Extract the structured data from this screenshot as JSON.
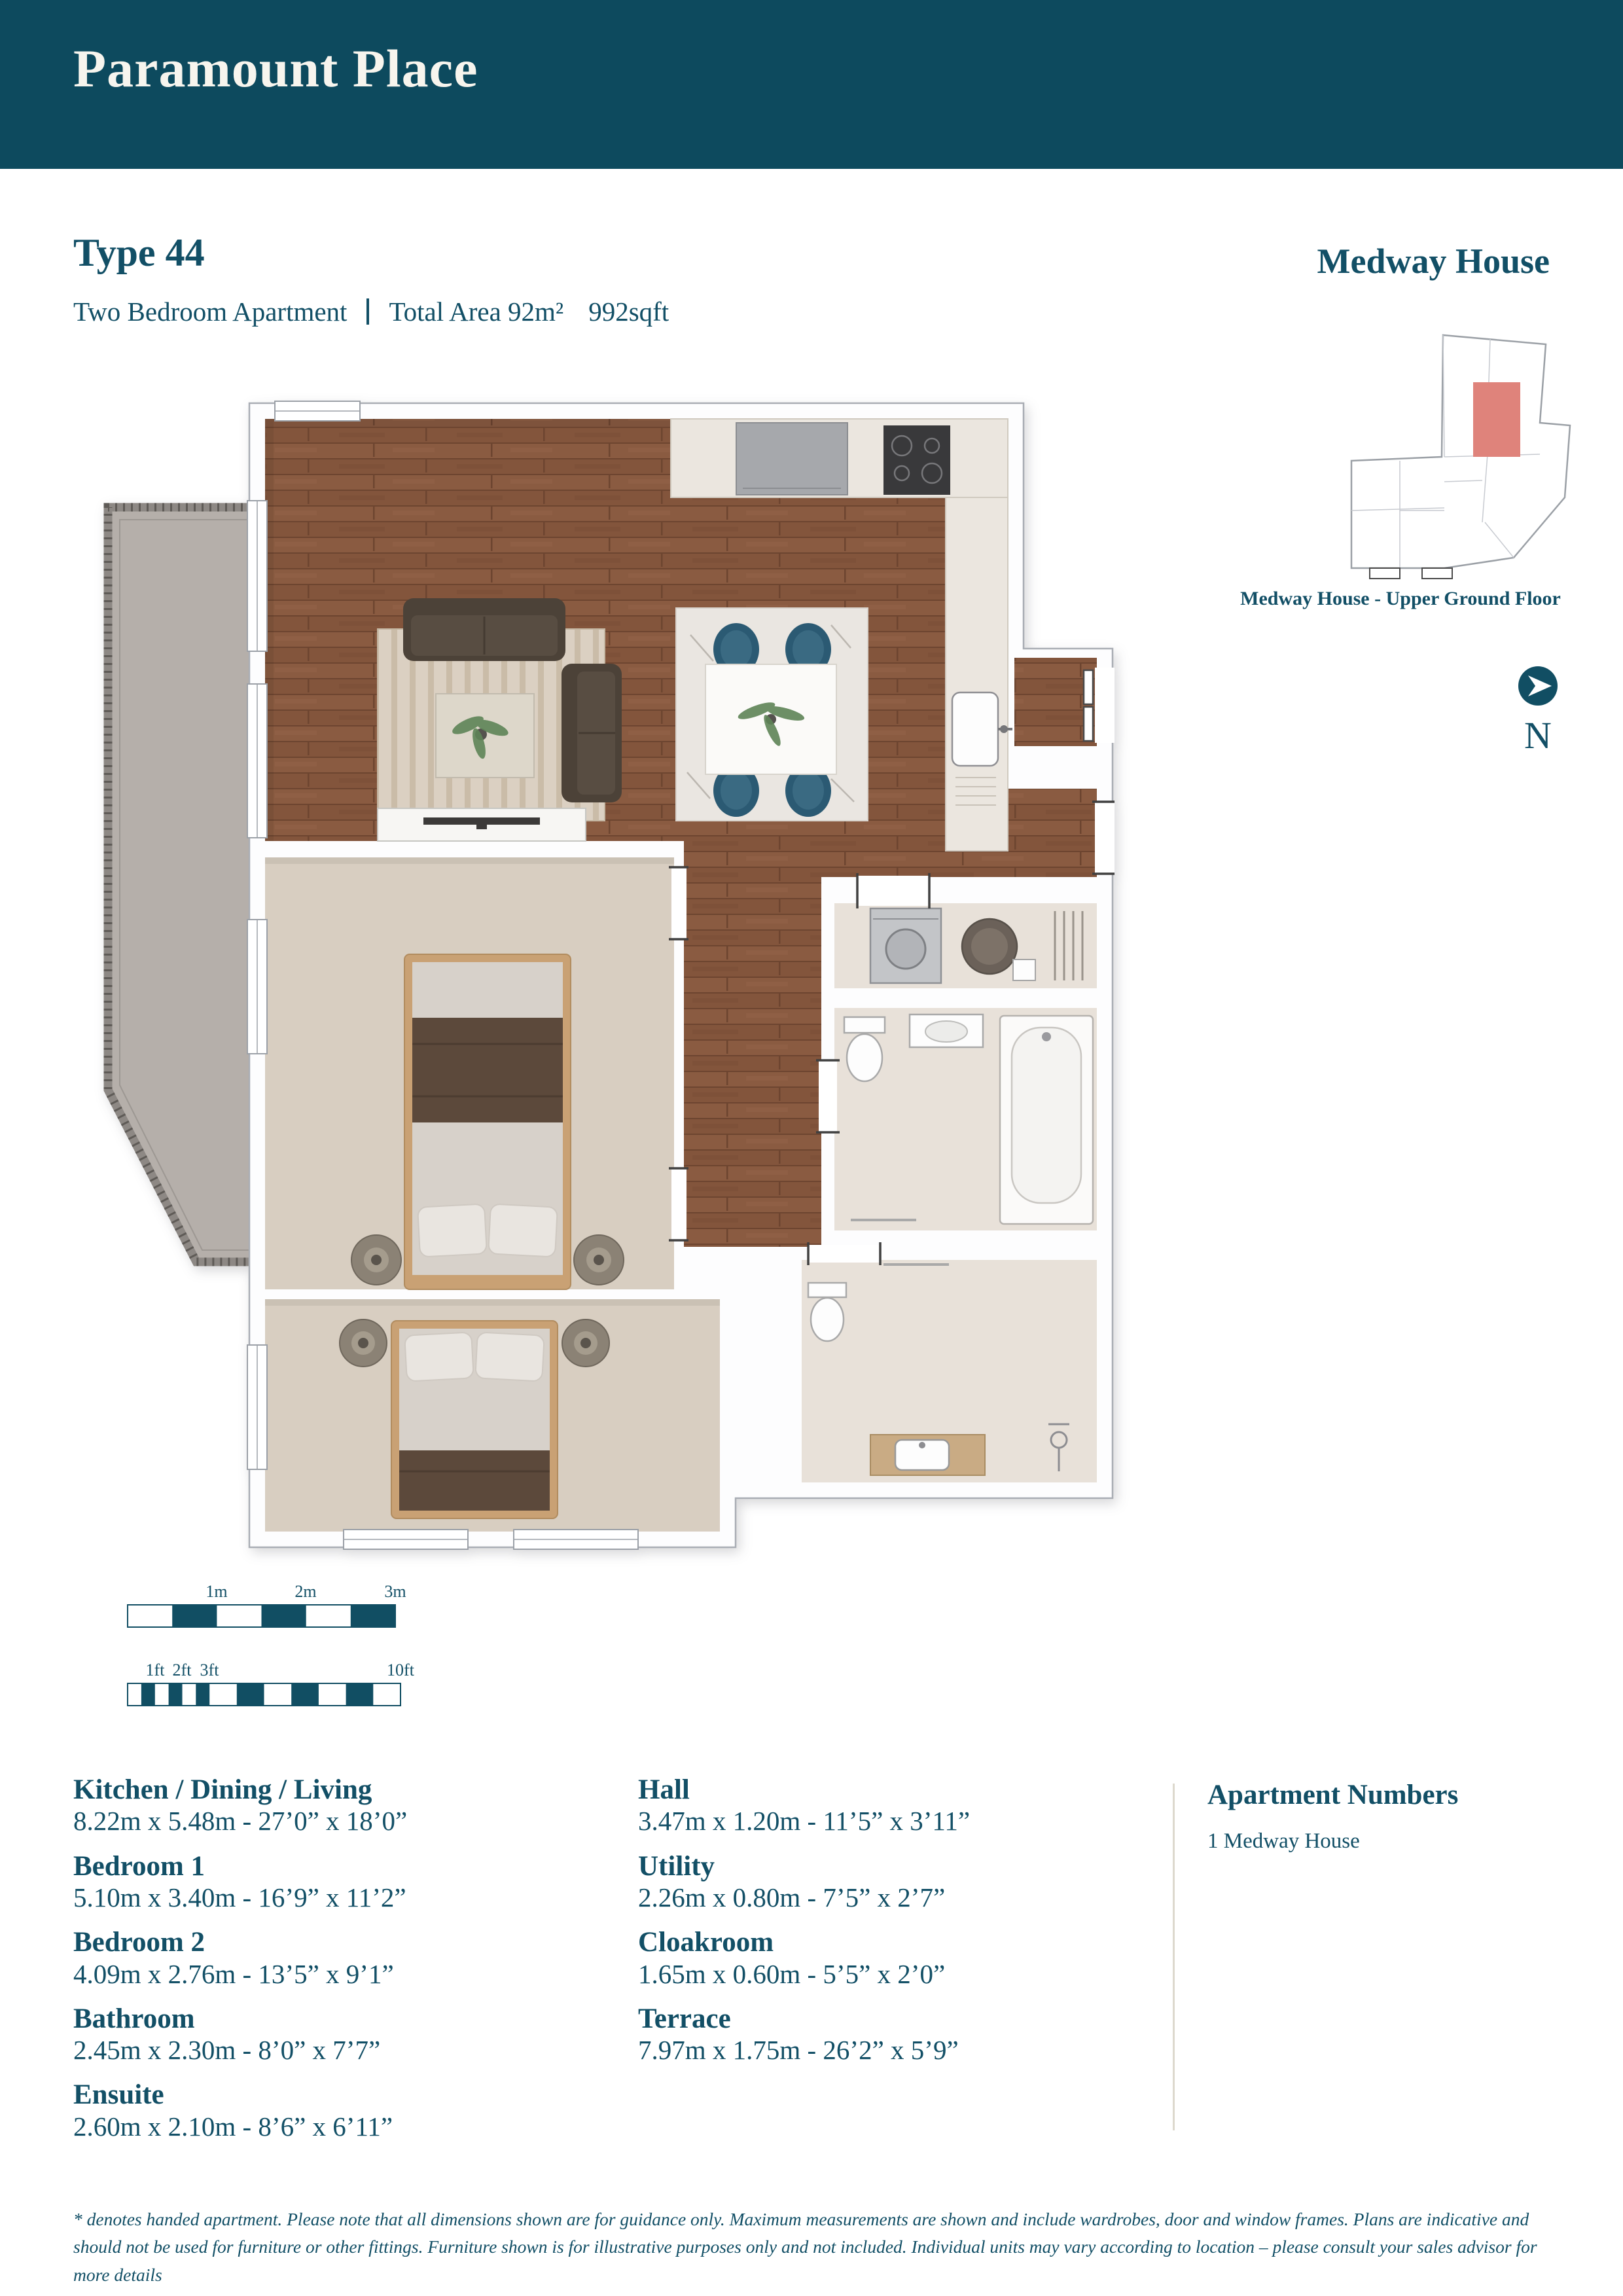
{
  "page": {
    "title": "Paramount Place"
  },
  "unit": {
    "type_label": "Type 44",
    "description": "Two Bedroom Apartment",
    "total_area": "Total Area 92m²",
    "area_sqft": "992sqft",
    "building": "Medway House"
  },
  "locator": {
    "caption": "Medway House - Upper Ground Floor",
    "north_label": "N",
    "highlight_color": "#df837b"
  },
  "scale_bars": {
    "metric_labels": [
      "1m",
      "2m",
      "3m"
    ],
    "imperial_labels": [
      "1ft",
      "2ft",
      "3ft",
      "10ft"
    ]
  },
  "rooms": [
    {
      "name": "Kitchen / Dining / Living",
      "dims": "8.22m x 5.48m  -  27’0” x 18’0”"
    },
    {
      "name": "Bedroom 1",
      "dims": "5.10m x 3.40m  -  16’9” x 11’2”"
    },
    {
      "name": "Bedroom 2",
      "dims": "4.09m x 2.76m  -  13’5” x 9’1”"
    },
    {
      "name": "Bathroom",
      "dims": "2.45m x 2.30m  -  8’0” x 7’7”"
    },
    {
      "name": "Ensuite",
      "dims": "2.60m x 2.10m  -  8’6” x 6’11”"
    },
    {
      "name": "Hall",
      "dims": "3.47m x 1.20m  -  11’5” x 3’11”"
    },
    {
      "name": "Utility",
      "dims": "2.26m x 0.80m  -  7’5” x 2’7”"
    },
    {
      "name": "Cloakroom",
      "dims": "1.65m x 0.60m  -  5’5” x 2’0”"
    },
    {
      "name": "Terrace",
      "dims": "7.97m x 1.75m  -  26’2” x 5’9”"
    }
  ],
  "apartment_numbers": {
    "heading": "Apartment Numbers",
    "items": [
      "1 Medway House"
    ]
  },
  "disclaimer": "* denotes handed apartment. Please note that all dimensions shown are for guidance only. Maximum measurements are shown and include wardrobes, door and window frames. Plans are indicative and should not be used for furniture or other fittings. Furniture shown is for illustrative purposes only and not included. Individual units may vary according to location – please consult your sales advisor for more details",
  "colors": {
    "header_bg": "#0d4a5e",
    "text_teal": "#124f66",
    "wood_floor": "#8a5b41",
    "carpet": "#d8cec1",
    "terrace": "#b5afaa",
    "locator_highlight": "#df837b",
    "dining_chair": "#2b5a73",
    "scale_bar": "#114e63"
  }
}
